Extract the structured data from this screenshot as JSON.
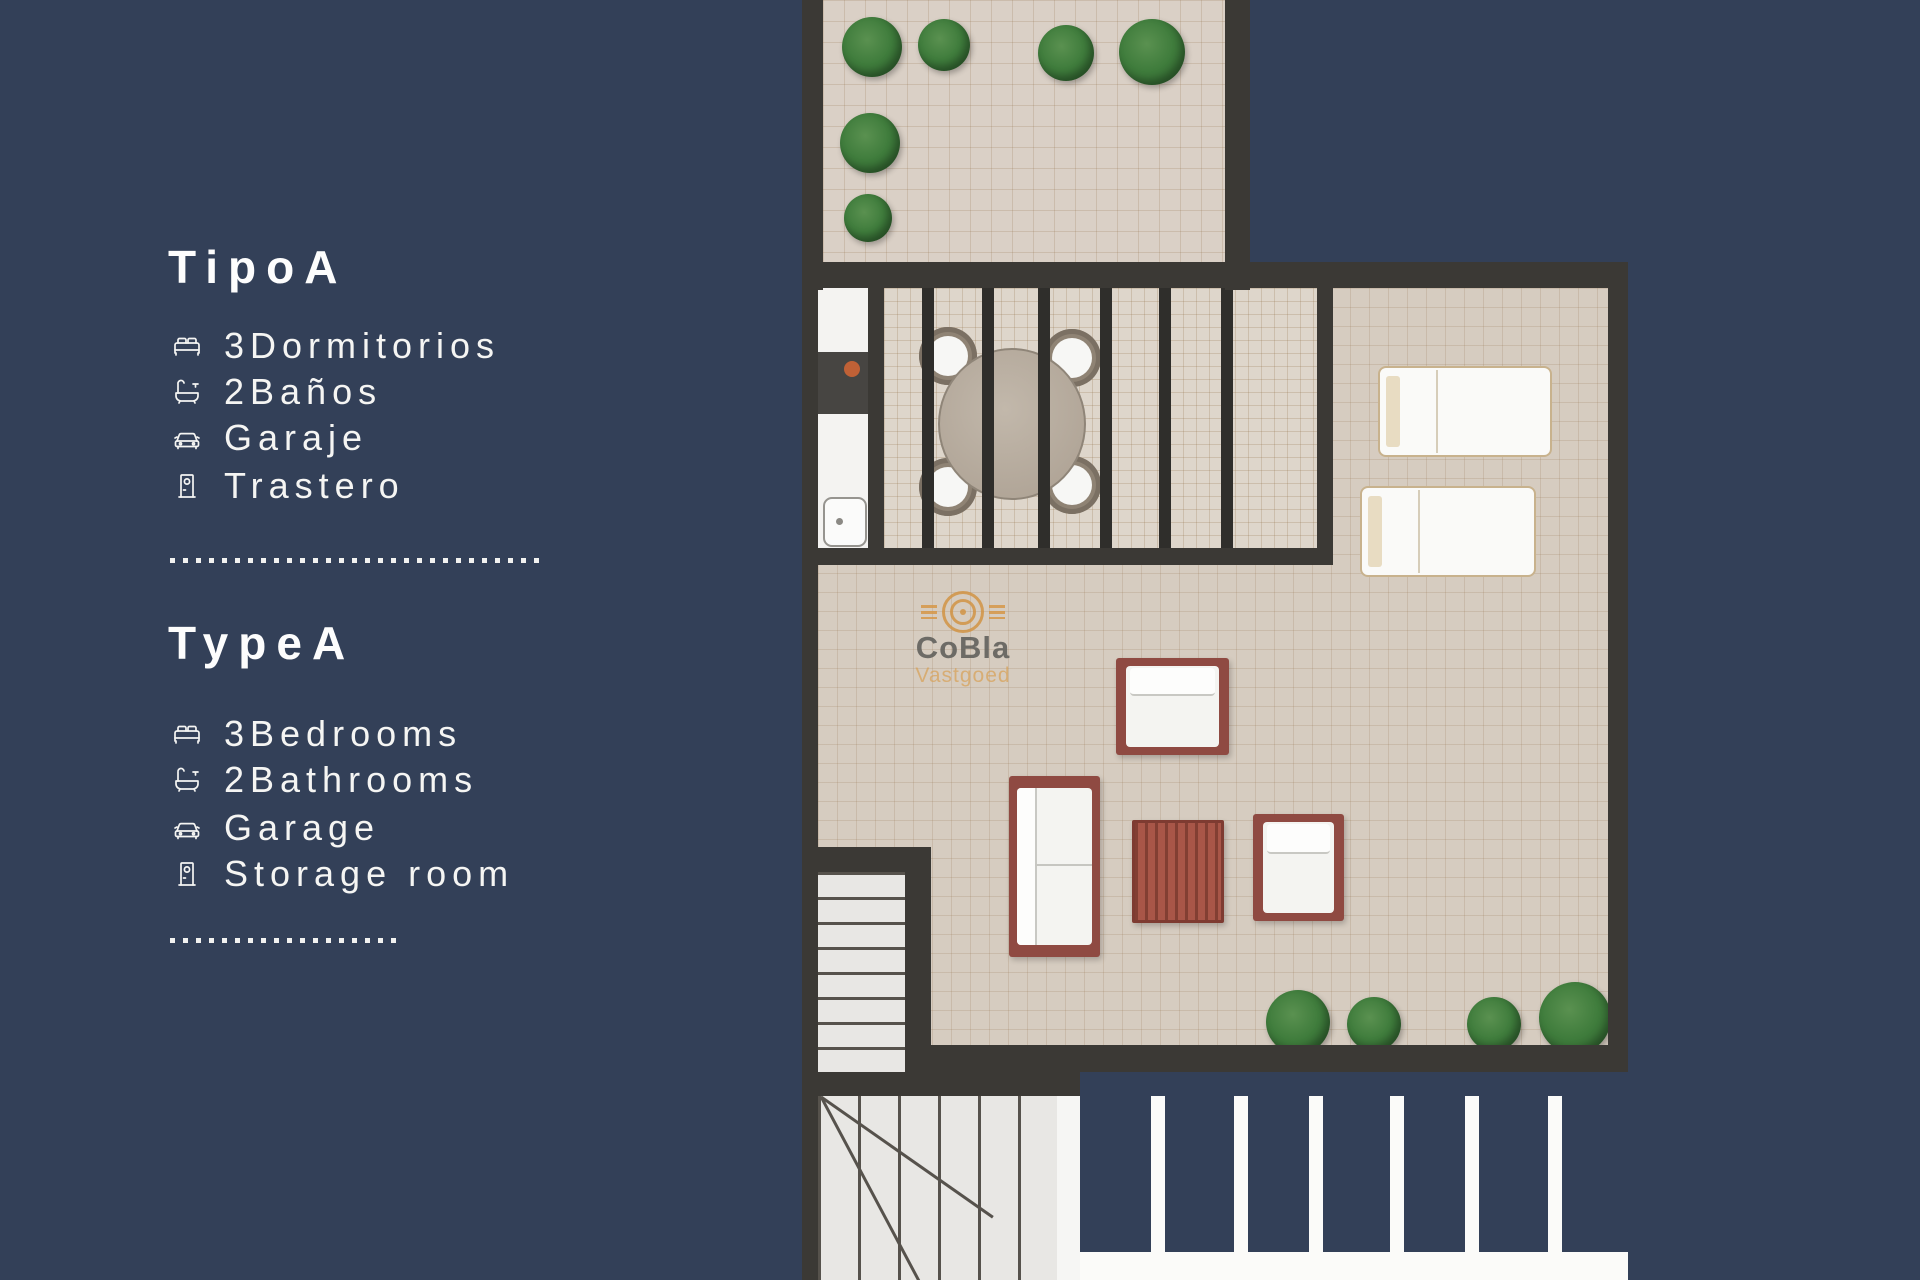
{
  "page": {
    "background_color": "#334058",
    "wall_color": "#3b3935",
    "tile_color": "#d6ccc0",
    "furniture_frame_color": "#8f4a42",
    "plant_color": "#3f7c3c",
    "text_color": "#f5f5f3"
  },
  "panel": {
    "es": {
      "title": "TipoA",
      "items": [
        {
          "icon": "bed-icon",
          "label": "3Dormitorios"
        },
        {
          "icon": "bath-icon",
          "label": "2Baños"
        },
        {
          "icon": "car-icon",
          "label": "Garaje"
        },
        {
          "icon": "door-icon",
          "label": "Trastero"
        }
      ]
    },
    "en": {
      "title": "TypeA",
      "items": [
        {
          "icon": "bed-icon",
          "label": "3Bedrooms"
        },
        {
          "icon": "bath-icon",
          "label": "2Bathrooms"
        },
        {
          "icon": "car-icon",
          "label": "Garage"
        },
        {
          "icon": "door-icon",
          "label": "Storage room"
        }
      ]
    }
  },
  "watermark": {
    "brand": "CoBla",
    "sub": "Vastgoed",
    "logo": "cobla-arcs-logo",
    "accent_color": "#d29242",
    "brand_text_color": "#5f5e5a"
  }
}
